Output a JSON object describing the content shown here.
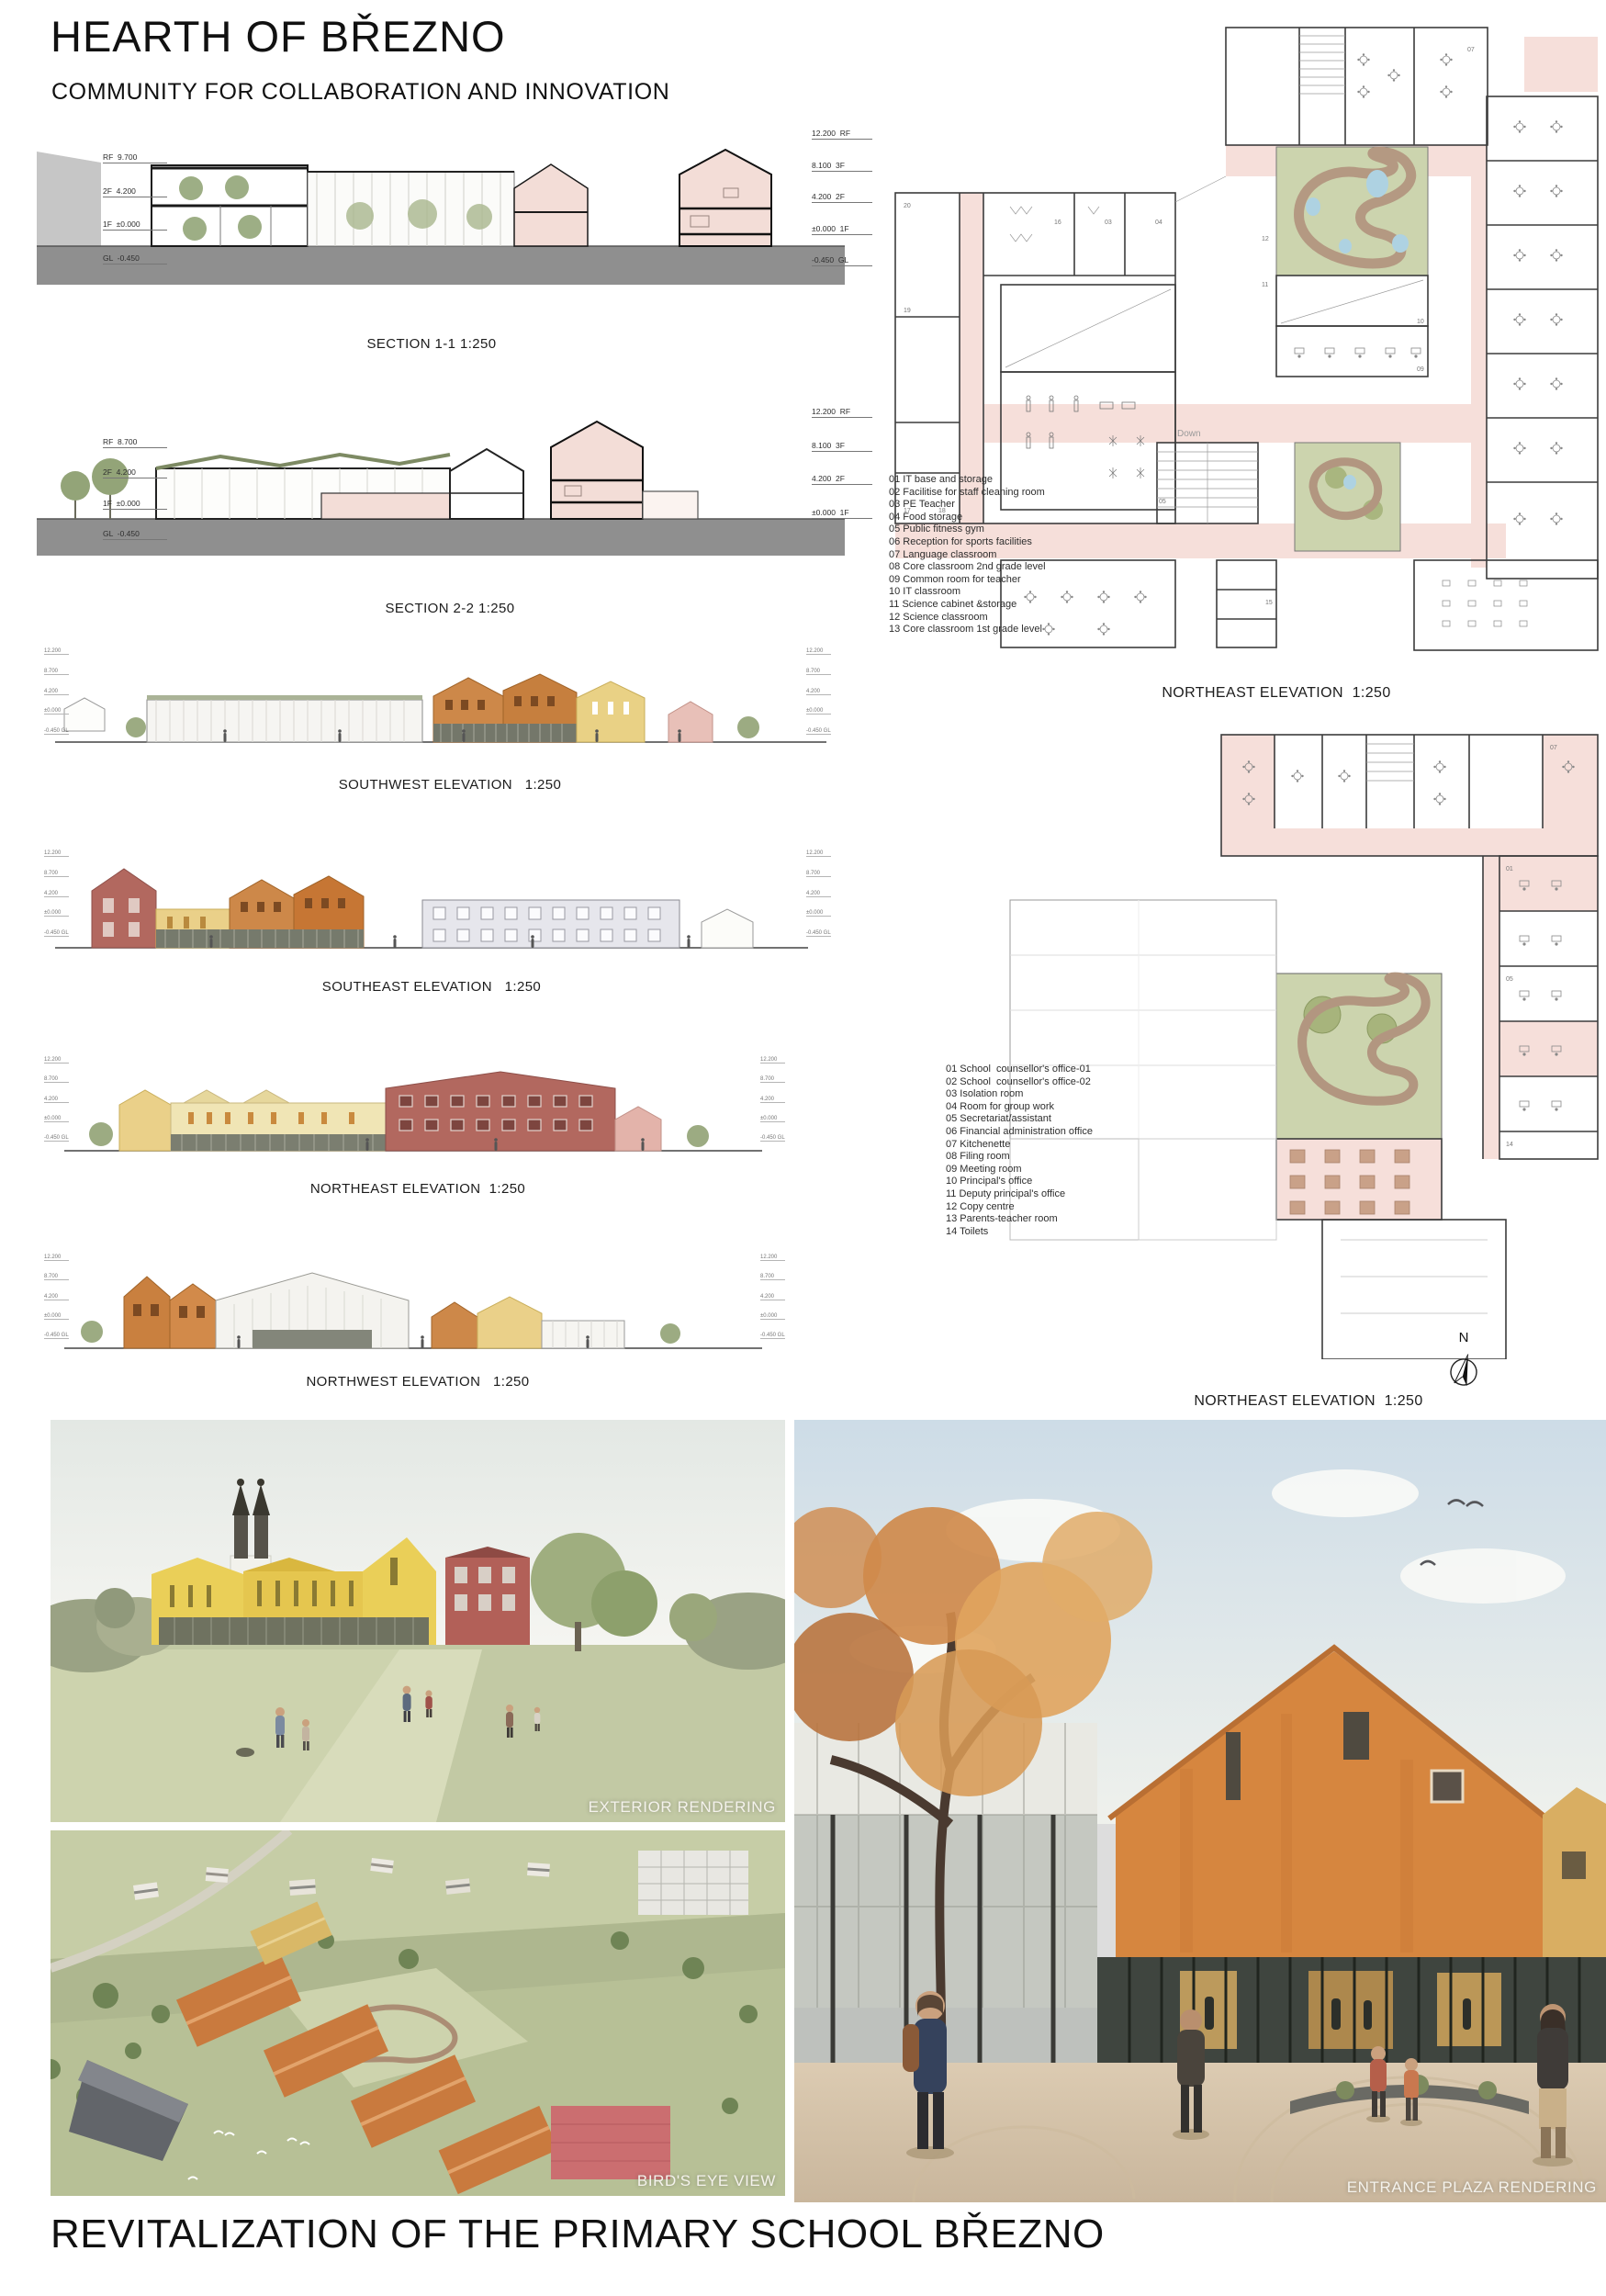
{
  "header": {
    "title": "HEARTH OF BŘEZNO",
    "subtitle": "COMMUNITY FOR COLLABORATION AND INNOVATION"
  },
  "footer": {
    "title": "REVITALIZATION OF THE PRIMARY SCHOOL BŘEZNO"
  },
  "sections": [
    {
      "label": "SECTION 1-1 1:250",
      "levels_left": [
        "RF  9.700",
        "2F  4.200",
        "1F  ±0.000",
        "GL  -0.450"
      ],
      "levels_right": [
        "12.200  RF",
        "8.100  3F",
        "4.200  2F",
        "±0.000  1F",
        "-0.450  GL"
      ]
    },
    {
      "label": "SECTION 2-2 1:250",
      "levels_left": [
        "RF  8.700",
        "2F  4.200",
        "1F  ±0.000",
        "GL  -0.450"
      ],
      "levels_right": [
        "12.200  RF",
        "8.100  3F",
        "4.200  2F",
        "±0.000  1F"
      ]
    }
  ],
  "elevations": [
    {
      "label": "SOUTHWEST ELEVATION   1:250",
      "levels": [
        "12.200",
        "8.700",
        "4.200",
        "±0.000",
        "-0.450 GL"
      ]
    },
    {
      "label": "SOUTHEAST ELEVATION   1:250",
      "levels": [
        "12.200",
        "8.700",
        "4.200",
        "±0.000",
        "-0.450 GL"
      ]
    },
    {
      "label": "NORTHEAST ELEVATION  1:250",
      "levels": [
        "12.200",
        "8.700",
        "4.200",
        "±0.000",
        "-0.450 GL"
      ]
    },
    {
      "label": "NORTHWEST ELEVATION   1:250",
      "levels": [
        "12.200",
        "8.700",
        "4.200",
        "±0.000",
        "-0.450 GL"
      ]
    }
  ],
  "plans": [
    {
      "label": "NORTHEAST ELEVATION  1:250",
      "down_label": "Down",
      "legend": [
        "01 IT base and storage",
        "02 Facilitise for staff cleaning room",
        "03 PE Teacher",
        "04 Food storage",
        "05 Public fitness gym",
        "06 Reception for sports facilities",
        "07 Language classroom",
        "08 Core classroom 2nd grade level",
        "09 Common room for teacher",
        "10 IT classroom",
        "11 Science cabinet &storage",
        "12 Science classroom",
        "13 Core classroom 1st grade level"
      ],
      "numbers": [
        "07",
        "12",
        "11",
        "09",
        "10",
        "16",
        "03",
        "04",
        "05",
        "15",
        "17",
        "18",
        "19",
        "20"
      ]
    },
    {
      "label": "NORTHEAST ELEVATION  1:250",
      "legend": [
        "01 School  counsellor's office-01",
        "02 School  counsellor's office-02",
        "03 Isolation room",
        "04 Room for group work",
        "05 Secretariat/assistant",
        "06 Financial administration office",
        "07 Kitchenette",
        "08 Filing room",
        "09 Meeting room",
        "10 Principal's office",
        "11 Deputy principal's office",
        "12 Copy centre",
        "13 Parents-teacher room",
        "14 Toilets"
      ],
      "numbers": [
        "01",
        "05",
        "07",
        "14"
      ]
    }
  ],
  "north": {
    "label": "N"
  },
  "renderings": [
    {
      "caption": "EXTERIOR RENDERING"
    },
    {
      "caption": "BIRD'S EYE VIEW"
    },
    {
      "caption": "ENTRANCE PLAZA RENDERING"
    }
  ],
  "colors": {
    "plan_pink": "#f6dfda",
    "courtyard_green": "#ccd4ae",
    "path_brown": "#b29680",
    "pond_blue": "#aed2e2",
    "section_pink": "#f3ddd7",
    "ground_gray": "#8f8f8f",
    "terracotta": "#cd8849",
    "maroon": "#b2685f",
    "yellow": "#ead089"
  }
}
